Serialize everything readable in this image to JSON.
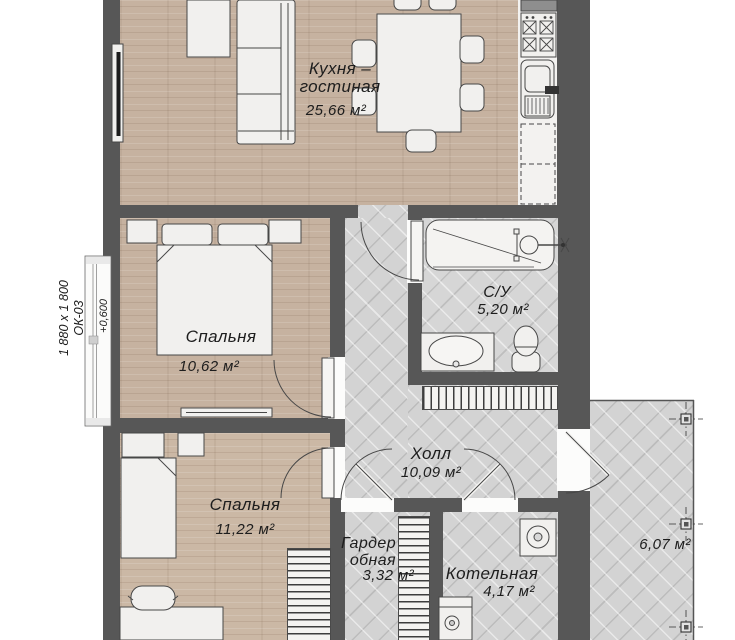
{
  "rooms": {
    "kitchen_living": {
      "name_line1": "Кухня –",
      "name_line2": "гостиная",
      "area": "25,66 м²"
    },
    "bedroom_1": {
      "name": "Спальня",
      "area": "10,62 м²"
    },
    "bedroom_2": {
      "name": "Спальня",
      "area": "11,22 м²"
    },
    "bathroom": {
      "name": "С/У",
      "area": "5,20 м²"
    },
    "hall": {
      "name": "Холл",
      "area": "10,09 м²"
    },
    "wardrobe": {
      "name_line1": "Гардер",
      "name_line2": "обная",
      "area": "3,32 м²"
    },
    "boiler_room": {
      "name": "Котельная",
      "area": "4,17 м²"
    },
    "porch": {
      "area": "6,07 м²"
    }
  },
  "annotations": {
    "window_dimensions": "1 880 x 1 800",
    "window_code": "ОК-03",
    "floor_elevation": "+0,600"
  },
  "palette": {
    "wall": "#575757",
    "wood_floor": "#c6b2a0",
    "tile_floor": "#d3d3d3",
    "furniture_fill": "#f1f0ee",
    "outline": "#474747",
    "label_text": "#1d1d1d"
  }
}
